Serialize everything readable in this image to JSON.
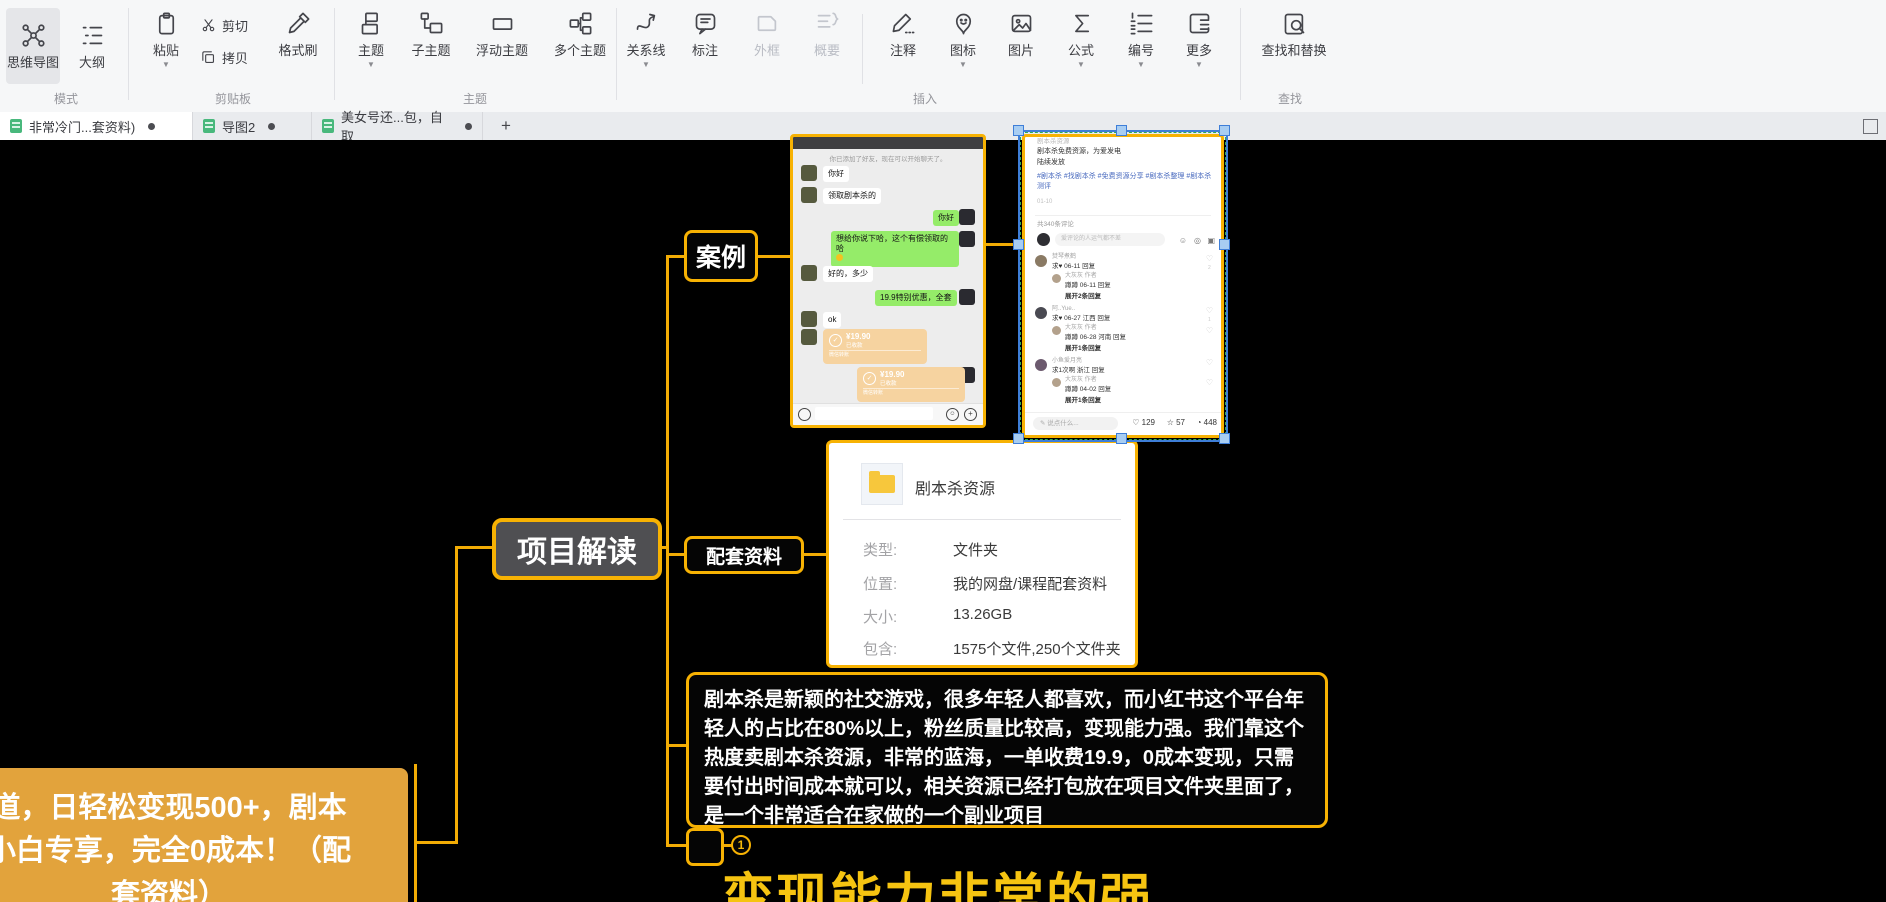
{
  "toolbar": {
    "mode": {
      "section": "模式",
      "mindmap": "思维导图",
      "outline": "大纲"
    },
    "clipboard": {
      "section": "剪贴板",
      "paste": "粘贴",
      "cut": "剪切",
      "copy": "拷贝",
      "painter": "格式刷"
    },
    "topic": {
      "section": "主题",
      "topic": "主题",
      "subtopic": "子主题",
      "floating": "浮动主题",
      "multiple": "多个主题"
    },
    "insert": {
      "section": "插入",
      "relation": "关系线",
      "callout": "标注",
      "boundary": "外框",
      "summary": "概要",
      "note": "注释",
      "icon": "图标",
      "image": "图片",
      "formula": "公式",
      "numbering": "编号",
      "more": "更多"
    },
    "find": {
      "section": "查找",
      "find_replace": "查找和替换"
    }
  },
  "tabs": {
    "tab1": "非常冷门...套资料)",
    "tab2": "导图2",
    "tab3": "美女号还...包，自取",
    "new_tab": "+"
  },
  "mindmap": {
    "root": "道，日轻松变现500+，剧本\n小白专享，完全0成本！（配\n套资料）",
    "project": "项目解读",
    "case": "案例",
    "materials": "配套资料",
    "paragraph": "剧本杀是新颖的社交游戏，很多年轻人都喜欢，而小红书这个平台年轻人的占比在80%以上，粉丝质量比较高，变现能力强。我们靠这个热度卖剧本杀资源，非常的蓝海，一单收费19.9，0成本变现，只需要付出时间成本就可以，相关资源已经打包放在项目文件夹里面了，是一个非常适合在家做的一个副业项目",
    "badge": "1",
    "big_topic": "变现能力非常的强"
  },
  "file_card": {
    "title": "剧本杀资源",
    "rows": [
      [
        "类型:",
        "文件夹"
      ],
      [
        "位置:",
        "我的网盘/课程配套资料"
      ],
      [
        "大小:",
        "13.26GB"
      ],
      [
        "包含:",
        "1575个文件,250个文件夹"
      ]
    ]
  },
  "wechat": {
    "system": "你已添加了好友，现在可以开始聊天了。",
    "msgs": {
      "hello_l": "你好",
      "get": "领取剧本杀的",
      "hello_r": "你好",
      "paid": "想给你说下哈，这个有偿领取的哈",
      "ask": "好的，多少",
      "offer": "19.9特别优惠，全套",
      "ok": "ok"
    },
    "transfer": {
      "amount": "¥19.90",
      "status": "已收款",
      "footer": "微信转账"
    }
  },
  "xhs": {
    "top": "剧本杀资源",
    "line1": "剧本杀免费资源，为爱发电",
    "line2": "陆续发放",
    "tags1": "#剧本杀 #找剧本杀 #免费资源分享 #剧本杀整理 #剧本杀",
    "tags2": "测评",
    "date": "01-10",
    "header": "共340条评论",
    "input_ph": "爱评论的人运气都不差",
    "c1": {
      "name": "焚琴煮鹤",
      "meta": "求♥ 06-11 回复",
      "like": "2",
      "rname": "大灰灰 作者",
      "rmeta": "蹲蹲 06-11 回复",
      "expand": "展开2条回复"
    },
    "c2": {
      "name": "阿..Yue..",
      "meta": "求♥ 06-27 江西 回复",
      "like": "1",
      "rname": "大灰灰 作者",
      "rmeta": "蹲蹲 06-28 河南 回复",
      "expand": "展开1条回复"
    },
    "c3": {
      "name": "小鱼爱月亮",
      "meta": "求1次啊 浙江 回复",
      "rname": "大灰灰 作者",
      "rmeta": "蹲蹲 04-02 回复",
      "expand": "展开1条回复"
    },
    "bottom": {
      "ph": "说点什么...",
      "like": "129",
      "star": "57",
      "cmt": "448"
    }
  }
}
